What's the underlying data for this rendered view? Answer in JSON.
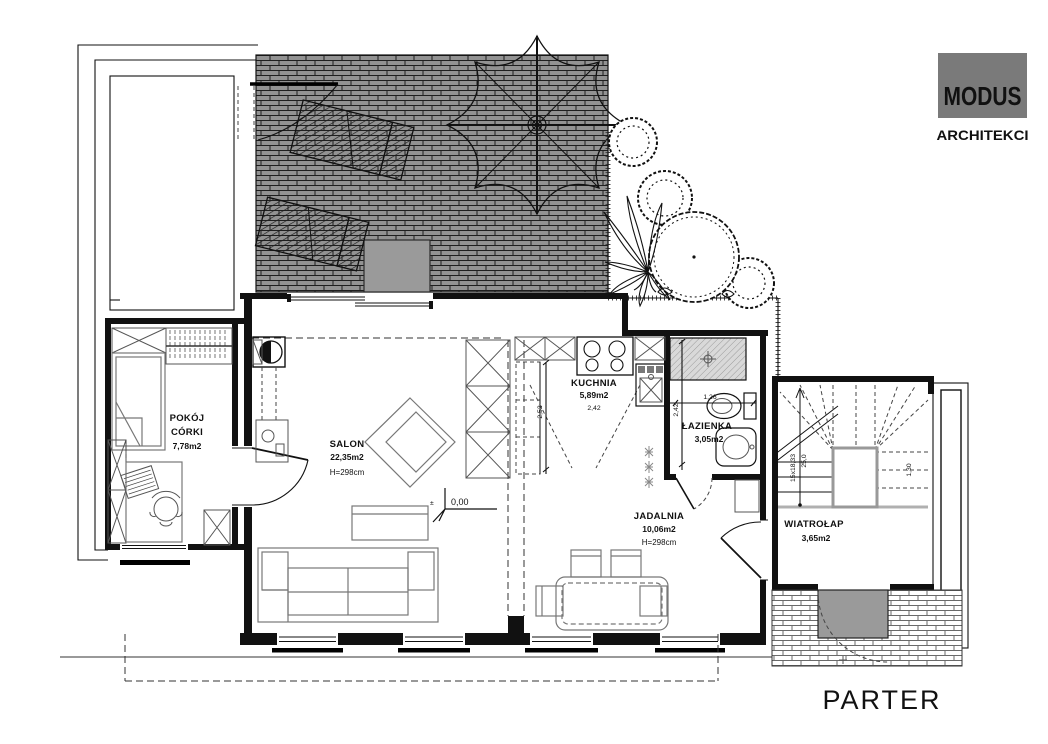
{
  "logo": {
    "brand": "MODUS",
    "subtitle": "ARCHITEKCI"
  },
  "title": "PARTER",
  "rooms": {
    "pokoj": {
      "name_line1": "POKÓJ",
      "name_line2": "CÓRKI",
      "area": "7,78m2"
    },
    "salon": {
      "name": "SALON",
      "area": "22,35m2",
      "height": "H=298cm"
    },
    "kuchnia": {
      "name": "KUCHNIA",
      "area": "5,89m2",
      "width": "2,42"
    },
    "lazienka": {
      "name": "ŁAZIENKA",
      "area": "3,05m2"
    },
    "jadalnia": {
      "name": "JADALNIA",
      "area": "10,06m2",
      "height": "H=298cm"
    },
    "wiatrolap": {
      "name": "WIATROŁAP",
      "area": "3,65m2"
    }
  },
  "dimensions": {
    "kitchen_depth": "2,52",
    "bath_width": "1,26",
    "bath_depth": "2,42",
    "stairs_steps": "15x18,33",
    "stairs_run": "25,0",
    "stairs_side": "1,30",
    "level_sign": "±",
    "level_value": "0,00"
  },
  "colors": {
    "brick_dark": "#929292",
    "logo_gray": "#7a7a7a",
    "mat_gray": "#9a9a9a"
  }
}
